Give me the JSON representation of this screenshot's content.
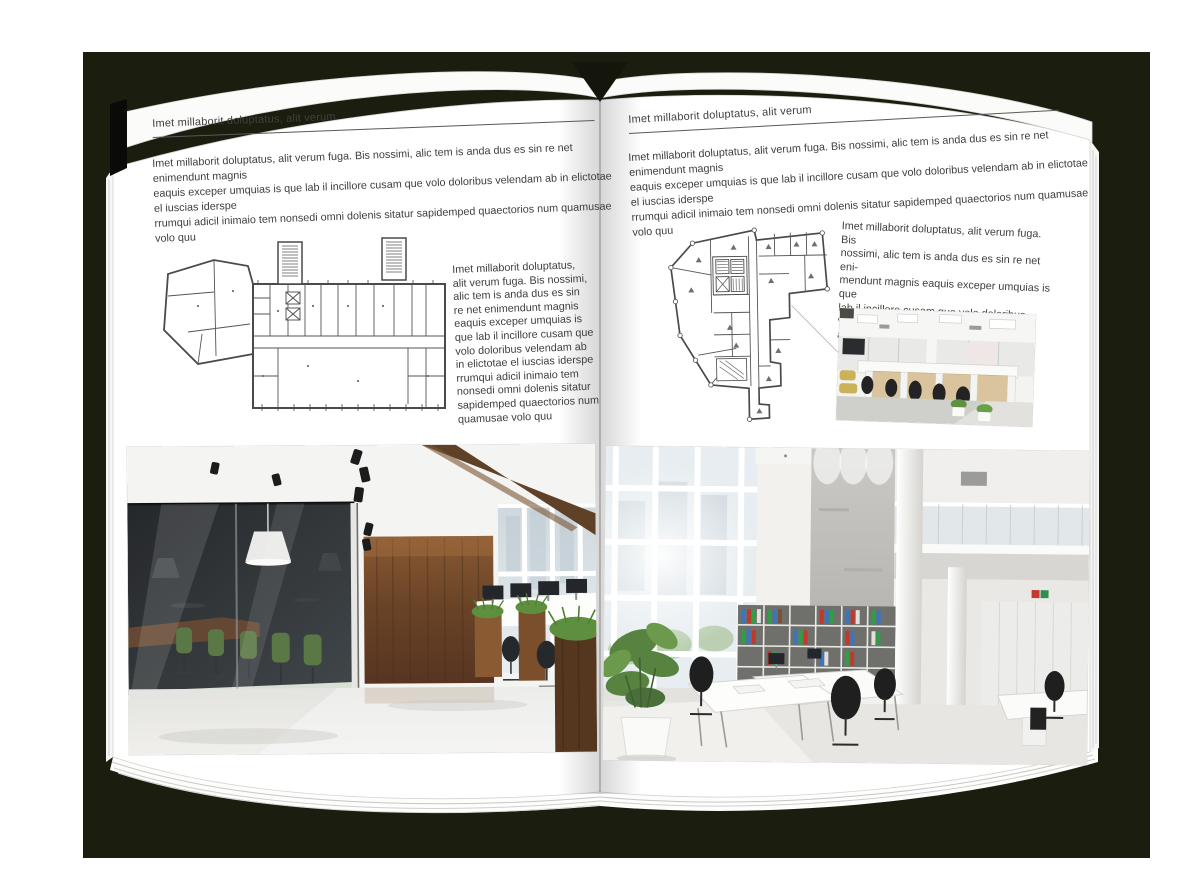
{
  "backdrop": {
    "color": "#1b1d0e"
  },
  "left_page": {
    "header": "Imet millaborit doluptatus, alit verum",
    "intro_lines": [
      "Imet millaborit doluptatus, alit verum fuga. Bis nossimi, alic tem is anda dus es sin re net enimendunt magnis",
      "eaquis exceper umquias is que lab il incillore cusam que volo doloribus velendam ab in elictotae el iuscias iderspe",
      "rrumqui adicil inimaio tem nonsedi omni dolenis sitatur sapidemped quaectorios num quamusae volo quu"
    ],
    "side_text_lines": [
      "Imet millaborit doluptatus,",
      "alit verum fuga. Bis nossimi,",
      "alic tem is anda dus es sin",
      "re net enimendunt magnis",
      "eaquis exceper umquias is",
      "que lab il incillore cusam que",
      "volo doloribus velendam ab",
      "in elictotae el iuscias iderspe",
      "rrumqui adicil inimaio tem",
      "nonsedi omni dolenis sitatur",
      "sapidemped quaectorios num",
      "quamusae volo quu"
    ]
  },
  "right_page": {
    "header": "Imet millaborit doluptatus, alit verum",
    "intro_lines": [
      "Imet millaborit doluptatus, alit verum fuga. Bis nossimi, alic tem is anda dus es sin re net enimendunt magnis",
      "eaquis exceper umquias is que lab il incillore cusam que volo doloribus velendam ab in elictotae el iuscias iderspe",
      "rrumqui adicil inimaio tem nonsedi omni dolenis sitatur sapidemped quaectorios num quamusae volo quu"
    ],
    "side_text_lines": [
      "Imet millaborit doluptatus, alit verum fuga. Bis",
      "nossimi, alic tem is anda dus es sin re net eni-",
      "mendunt magnis eaquis exceper umquias is que",
      "lab il incillore cusam que volo doloribus velendam",
      "ab in elictotae el iuscias iders"
    ]
  }
}
